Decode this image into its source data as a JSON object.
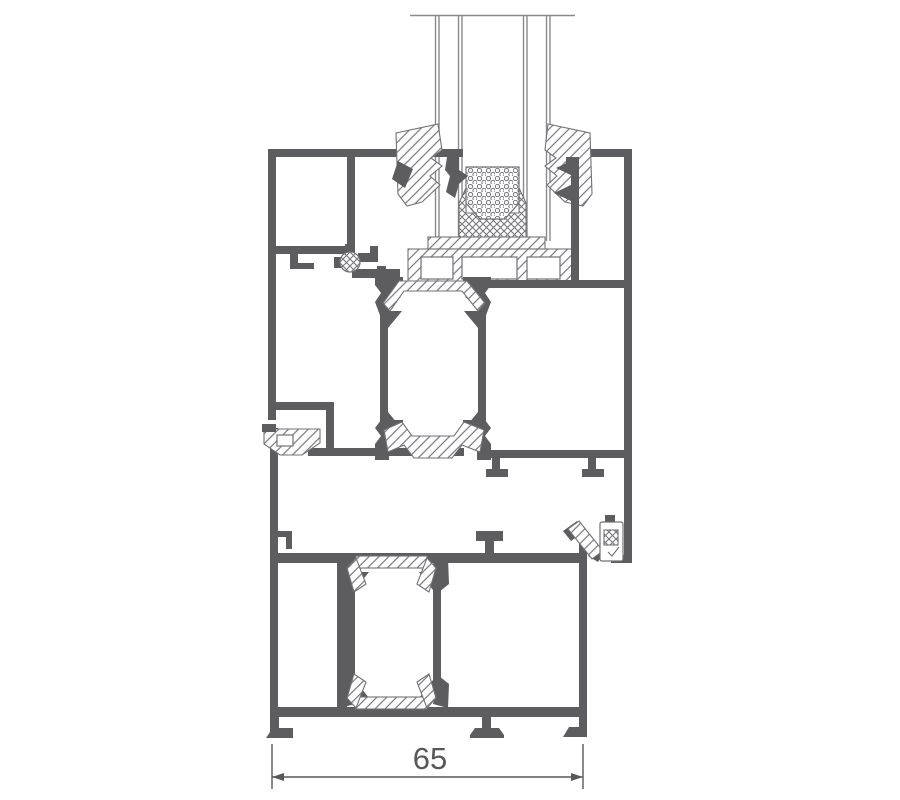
{
  "drawing": {
    "dimension_label": "65",
    "colors": {
      "profile": "#5d5d60",
      "outline": "#727275",
      "hatch": "#77777b",
      "glass_line": "#8a8a8e",
      "dim": "#58585a",
      "background": "#ffffff"
    }
  }
}
